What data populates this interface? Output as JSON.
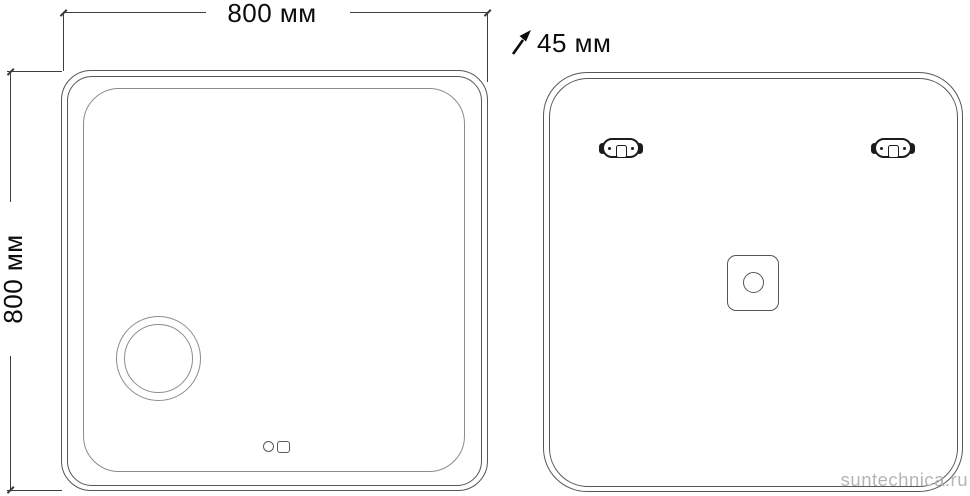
{
  "drawing": {
    "width_label": "800 мм",
    "height_label": "800 мм",
    "depth_label": "45 мм"
  },
  "watermark": "suntechnica.ru",
  "colors": {
    "line": "#3d3d3d",
    "outline": "#565656",
    "outline_light": "#8c8c8c",
    "dark": "#1c1c1c",
    "text": "#0c0c0c",
    "watermark_color": "#b5b5b5",
    "background": "#ffffff"
  },
  "icons": {
    "depth_arrow": "ne-arrow",
    "front_features": [
      "magnifying-mirror",
      "touch-sensor-circle",
      "touch-sensor-square"
    ],
    "back_features": [
      "mounting-bracket-left",
      "mounting-bracket-right",
      "junction-box"
    ]
  }
}
